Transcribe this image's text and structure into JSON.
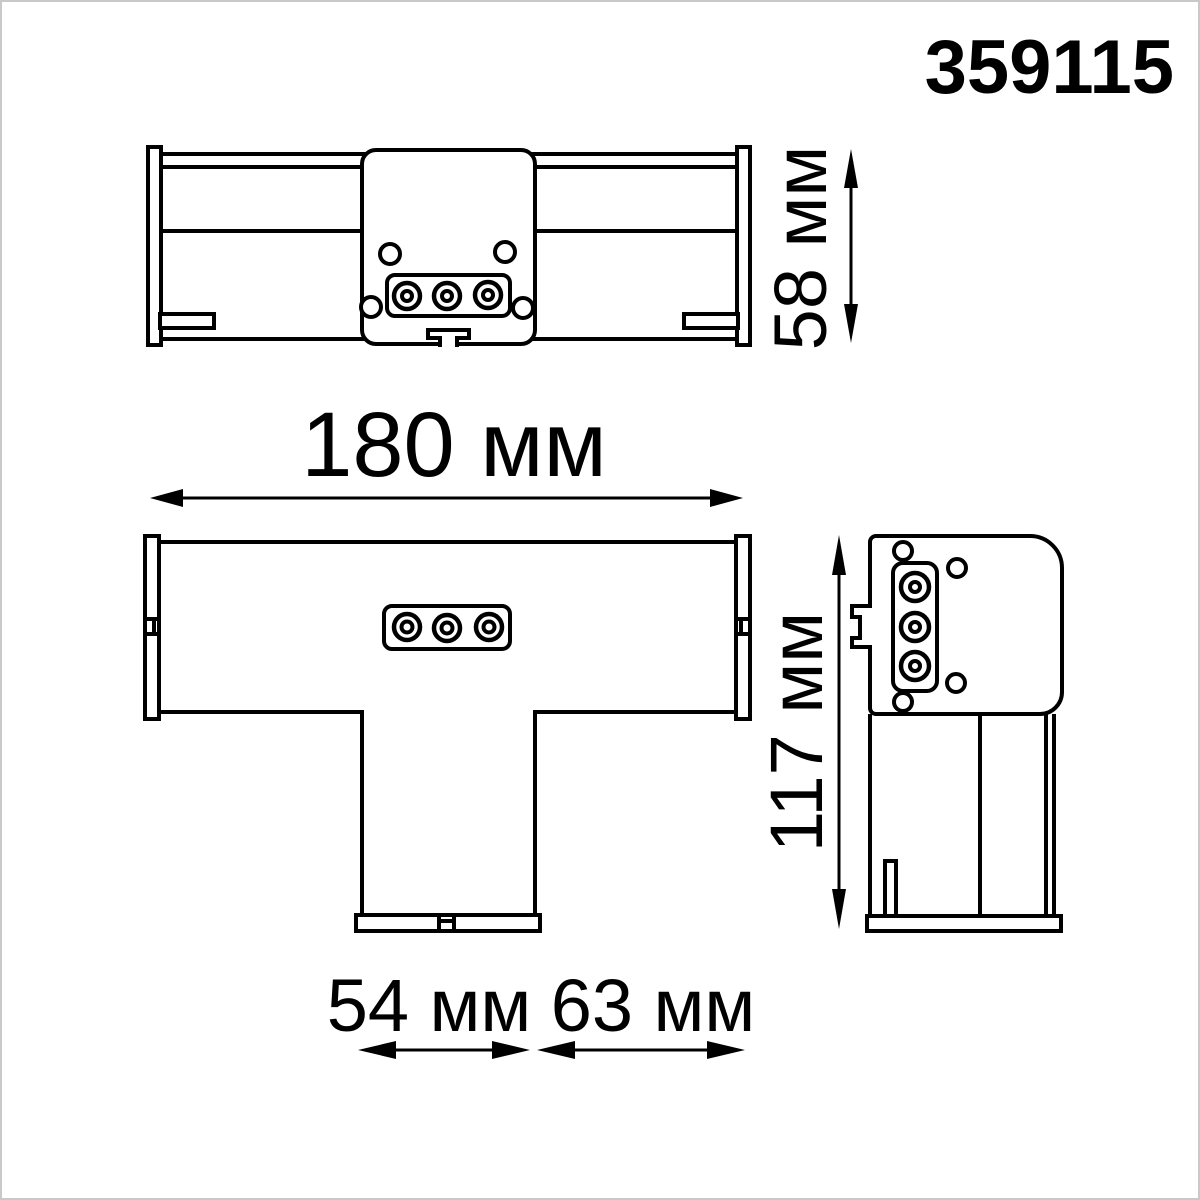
{
  "part_number": "359115",
  "colors": {
    "line": "#000000",
    "background": "#ffffff",
    "frame": "#c9c9c9"
  },
  "dimensions": {
    "height": "58 мм",
    "length": "180 мм",
    "depth": "117 мм",
    "stem_width": "54 мм",
    "branch_width": "63 мм"
  }
}
